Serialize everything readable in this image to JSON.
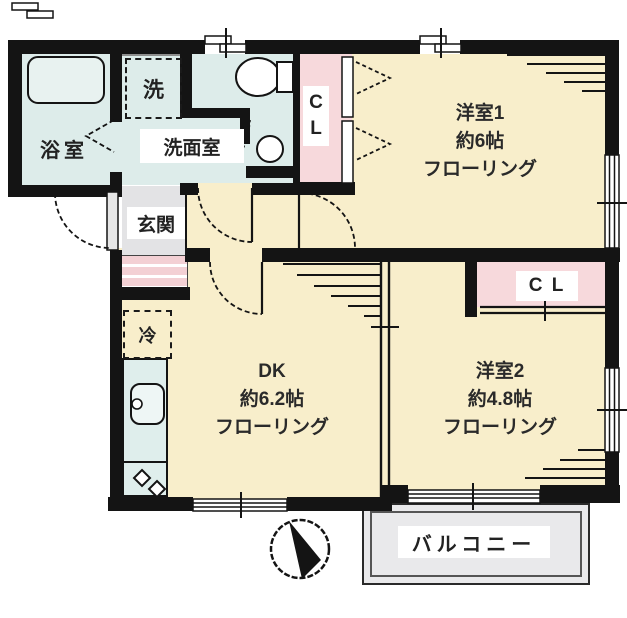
{
  "floorplan": {
    "rooms": {
      "bath": "浴室",
      "washer": "洗",
      "washroom": "洗面室",
      "entrance": "玄関",
      "fridge": "冷",
      "closet1_line1": "C",
      "closet1_line2": "L",
      "closet2": "C L",
      "balcony": "バルコニー",
      "western1": {
        "name": "洋室1",
        "area": "約6帖",
        "flooring": "フローリング"
      },
      "western2": {
        "name": "洋室2",
        "area": "約4.8帖",
        "flooring": "フローリング"
      },
      "dk": {
        "name": "DK",
        "area": "約6.2帖",
        "flooring": "フローリング"
      }
    },
    "colors": {
      "room_yellow": "#f8eecb",
      "wet_blue": "#ddecea",
      "closet_pink": "#f7d9dc",
      "entrance_grey": "#e3e3e5",
      "step_pink": "#f3d0d4",
      "balcony_grey": "#e9e9eb",
      "wall": "#141414"
    }
  }
}
